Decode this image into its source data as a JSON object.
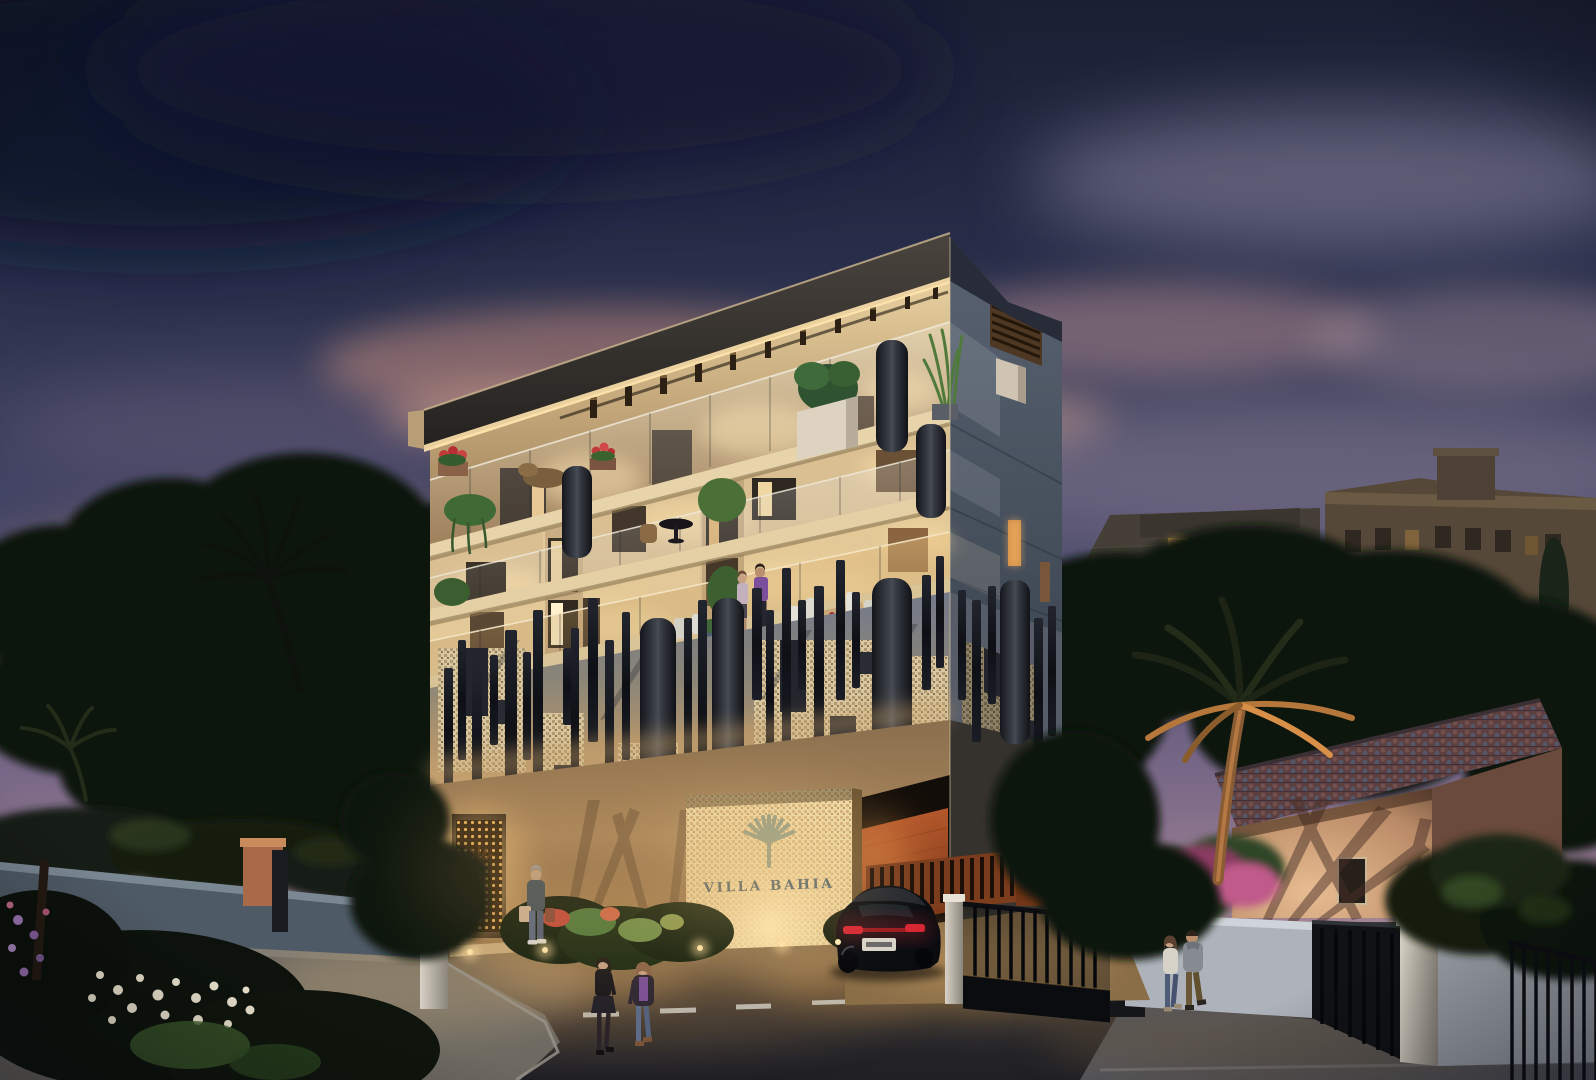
{
  "meta": {
    "type": "architectural-rendering",
    "setting": "modern residential building on a riviera street at dusk",
    "style": "photorealistic 3D visualization, blue hour lighting"
  },
  "signage": {
    "building_name": "VILLA BAHIA",
    "logo": "palm-fan-logo",
    "panel": "backlit mosaic entrance wall"
  },
  "palette": {
    "sky_top": "#1a1f33",
    "sky_mauve": "#796887",
    "sunset_glow": "#eaa86f",
    "cloud_pink": "#c08a7c",
    "facade_warm": "#cfae7e",
    "facade_glow": "#ffe3ac",
    "side_face": "#49525f",
    "screen_band_grey": "#747a8a",
    "mosaic_panel": "#d8c6a0",
    "baffle_dark": "#14161c",
    "terracotta": "#b4582c",
    "glass_glow": "#ffe9bb",
    "street": "#2c2c30",
    "marking_white": "#d2cfc6",
    "marking_yellow": "#b5923f",
    "foliage_dark": "#10150e",
    "foliage_lit": "#4f7a3c",
    "flower_red": "#c23a3a",
    "bougainvillea": "#c05a8a",
    "car_black": "#0a0c10",
    "tail_light": "#d42430"
  },
  "main_building": {
    "floors_top_to_bottom": [
      "roof slab with timber pergola rafters",
      "penthouse terrace with planters and mesh column",
      "balcony level with glass balustrades and round table",
      "terrace level with outdoor dining and residents",
      "decorative band of perforated mosaic panels and charcoal baffles",
      "street level with entrance screen, sign wall and car ramp"
    ],
    "front_face": "warm beige, interior glow",
    "side_face": "dark slate with small lit openings",
    "features": [
      "glass balustrades",
      "perforated metal cylinders",
      "mosaic screen panels",
      "balcony greenery",
      "rooftop pergola"
    ]
  },
  "street_level": {
    "entrance_screen": "backlit perforated brass door",
    "sign_wall": "illuminated mosaic with palm logo",
    "garage": "open ramp with lit terracotta walls and slat fence",
    "gate": "black sliding gate, open, with light pillar",
    "ground_lights": 5
  },
  "vehicle": {
    "type": "black sports coupe",
    "view": "rear three-quarter",
    "state": "turning into the ramp",
    "tail_lights": "lit red",
    "license_plate": "illegible white plate"
  },
  "people": [
    {
      "label": "man with shopping bags",
      "location": "entrance walkway",
      "clothing": "teal jacket, jeans, white sneakers"
    },
    {
      "label": "woman in black",
      "location": "crossing the street",
      "clothing": "black top, dark skirt, tights"
    },
    {
      "label": "woman in purple",
      "location": "crossing the street",
      "clothing": "purple top, dark jacket, blue jeans"
    },
    {
      "label": "couple on sidewalk",
      "location": "right sidewalk",
      "clothing": "white top with jeans; grey hoodie with brown trousers"
    },
    {
      "label": "couple on terrace",
      "location": "second floor terrace",
      "clothing": "lavender top; purple shirt"
    }
  ],
  "surroundings": {
    "left": [
      "silhouetted pines and palms",
      "sunset glow on the horizon",
      "garden wall with terracotta gate pillar",
      "illuminated white flower bed"
    ],
    "right": [
      "dark apartment blocks with a few lit windows",
      "ochre building with rooftop tower",
      "cypress",
      "tiled roof villa with palm shadows",
      "white boundary wall with black iron gates",
      "bougainvillea"
    ],
    "street": {
      "surface": "dark asphalt",
      "markings": [
        "white dashed center line",
        "yellow edge line"
      ],
      "sidewalks": "both sides"
    }
  }
}
